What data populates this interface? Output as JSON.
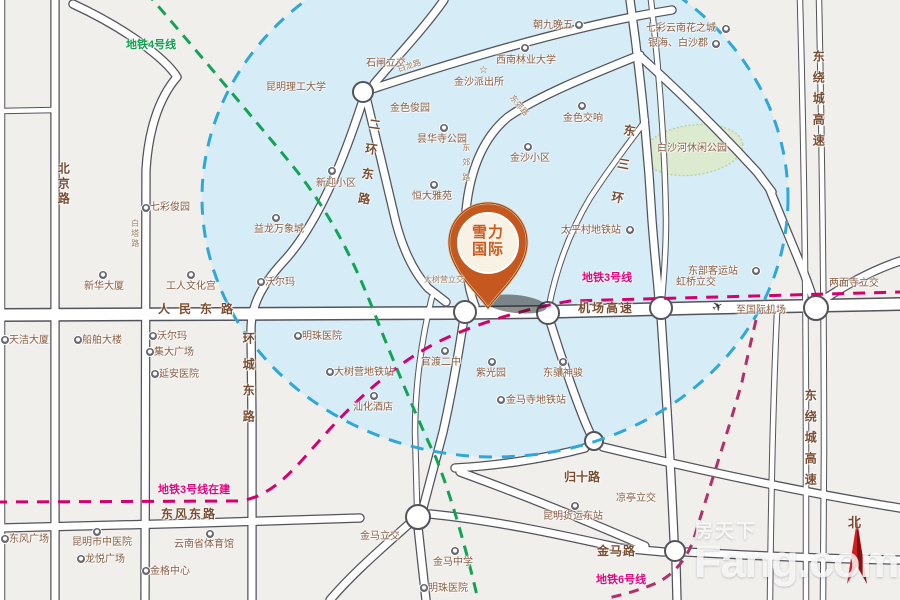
{
  "pin": {
    "line1": "雪力",
    "line2": "国际"
  },
  "watermark": {
    "cn": "房天下",
    "en": "Fang.com"
  },
  "compass": {
    "label": "北"
  },
  "glyphs": {
    "star": "☆",
    "plane": "✈"
  },
  "colors": {
    "background": "#f0efec",
    "coverage_zone_fill": "#d6ecf7",
    "coverage_zone_border": "#2ea7da",
    "metro_line4_green": "#12a355",
    "metro_line3_magenta": "#d4006e",
    "metro_line6_magenta": "#b13069",
    "road_fill": "#ffffff",
    "road_casing": "#53535b",
    "label_brown": "#8a5c40",
    "pin_orange": "#c4581f",
    "park_green": "#dcead0",
    "compass_red": "#cf1f1f"
  },
  "metro_labels": [
    {
      "n": "metro-line4-label",
      "t": "地铁4号线",
      "x": 126,
      "y": 39,
      "c": "green"
    },
    {
      "n": "metro-line3-label",
      "t": "地铁3号线",
      "x": 582,
      "y": 272,
      "c": "pink"
    },
    {
      "n": "metro-line3-construction-label",
      "t": "地铁3号线在建",
      "x": 158,
      "y": 484,
      "c": "pink"
    },
    {
      "n": "metro-line6-label",
      "t": "地铁6号线",
      "x": 596,
      "y": 574,
      "c": "pink"
    }
  ],
  "road_labels": [
    {
      "n": "road-label-renmin-donglu",
      "t": "人民东路",
      "x": 158,
      "y": 303,
      "ls": 9
    },
    {
      "n": "road-label-jichang-gaosu",
      "t": "机场高速",
      "x": 578,
      "y": 302,
      "ls": 2
    },
    {
      "n": "road-label-dongfeng-donglu",
      "t": "东风东路",
      "x": 161,
      "y": 508,
      "ls": 2
    },
    {
      "n": "road-label-jinma-lu",
      "t": "金马路",
      "x": 597,
      "y": 545,
      "ls": 1
    },
    {
      "n": "road-label-guishi-lu",
      "t": "归十路",
      "x": 564,
      "y": 471,
      "ls": 0
    },
    {
      "n": "road-label-beijing-lu",
      "t": "北京路",
      "x": 56,
      "y": 162,
      "v": 1,
      "ls": 3
    },
    {
      "n": "road-label-erhuan-donglu",
      "t": "二环东路",
      "x": 368,
      "y": 117,
      "v": 1,
      "ls": 13,
      "r": 8
    },
    {
      "n": "road-label-huancheng-donglu",
      "t": "环城东路",
      "x": 241,
      "y": 332,
      "v": 1,
      "ls": 14
    },
    {
      "n": "road-label-dongsanhuan",
      "t": "东三环",
      "x": 623,
      "y": 123,
      "v": 1,
      "ls": 22,
      "r": 10
    },
    {
      "n": "road-label-raocheng-north",
      "t": "东绕城高速",
      "x": 811,
      "y": 50,
      "v": 1,
      "ls": 9
    },
    {
      "n": "road-label-raocheng-south",
      "t": "东绕城高速",
      "x": 803,
      "y": 389,
      "v": 1,
      "ls": 9
    }
  ],
  "micro_labels": [
    {
      "n": "road-label-dongjiao-lu-vert",
      "t": "东郊路",
      "x": 461,
      "y": 143,
      "v": 1,
      "ls": 7
    },
    {
      "n": "road-label-dongjiao-lu-curve",
      "t": "东郊路",
      "x": 514,
      "y": 94,
      "r": 50
    },
    {
      "n": "road-label-bailong-lu",
      "t": "白龙路",
      "x": 397,
      "y": 66,
      "r": -17
    },
    {
      "n": "road-label-baita-lu",
      "t": "白塔路",
      "x": 130,
      "y": 219,
      "v": 1,
      "ls": 2
    }
  ],
  "poi_labels": [
    {
      "n": "poi-chaojiuwanwu",
      "t": "朝九晚五",
      "x": 533,
      "y": 20
    },
    {
      "n": "poi-qicai-yunnan-huazhicheng",
      "t": "七彩云南花之城",
      "x": 646,
      "y": 23
    },
    {
      "n": "poi-yinhai-baishajun",
      "t": "银海、白沙郡",
      "x": 648,
      "y": 38
    },
    {
      "n": "poi-kunming-ligong-daxue",
      "t": "昆明理工大学",
      "x": 266,
      "y": 82
    },
    {
      "n": "poi-shizha-lijiao",
      "t": "石闸立交",
      "x": 366,
      "y": 58
    },
    {
      "n": "poi-xinan-linye-daxue",
      "t": "西南林业大学",
      "x": 496,
      "y": 55
    },
    {
      "n": "poi-jinsha-paichusuo",
      "t": "金沙派出所",
      "x": 454,
      "y": 77
    },
    {
      "n": "poi-jinse-junyuan",
      "t": "金色俊园",
      "x": 390,
      "y": 103
    },
    {
      "n": "poi-jinse-jiaoxiang",
      "t": "金色交响",
      "x": 563,
      "y": 113
    },
    {
      "n": "poi-tanhuasi-gongyuan",
      "t": "昙华寺公园",
      "x": 417,
      "y": 134
    },
    {
      "n": "poi-jinsha-xiaoqu",
      "t": "金沙小区",
      "x": 510,
      "y": 153
    },
    {
      "n": "poi-xinying-xiaoqu",
      "t": "新迎小区",
      "x": 316,
      "y": 178
    },
    {
      "n": "poi-hengda-yayuan",
      "t": "恒大雅苑",
      "x": 412,
      "y": 191
    },
    {
      "n": "poi-baishahe-park",
      "t": "白沙河休闲公园",
      "x": 657,
      "y": 143
    },
    {
      "n": "poi-qicai-junyuan",
      "t": "七彩俊园",
      "x": 150,
      "y": 202
    },
    {
      "n": "poi-yilong-wanxiangcheng",
      "t": "益龙万象城",
      "x": 254,
      "y": 224
    },
    {
      "n": "poi-walmart-north",
      "t": "沃尔玛",
      "x": 265,
      "y": 277
    },
    {
      "n": "poi-xinhua-dasha",
      "t": "新华大厦",
      "x": 84,
      "y": 281
    },
    {
      "n": "poi-gongren-wenhuagong",
      "t": "工人文化宫",
      "x": 166,
      "y": 281
    },
    {
      "n": "poi-taipingcun-ditiezhan",
      "t": "太平村地铁站",
      "x": 561,
      "y": 225
    },
    {
      "n": "poi-dashuying-lijiao",
      "t": "大树营立交",
      "x": 424,
      "y": 276,
      "cls": "micro"
    },
    {
      "n": "poi-dongbu-keyunzhan",
      "t": "东部客运站",
      "x": 688,
      "y": 266
    },
    {
      "n": "poi-hongqiao-lijiao",
      "t": "虹桥立交",
      "x": 676,
      "y": 277
    },
    {
      "n": "poi-liangmiansi-lijiao",
      "t": "两面寺立交",
      "x": 829,
      "y": 278
    },
    {
      "n": "poi-zhi-guoji-jichang",
      "t": "至国际机场",
      "x": 736,
      "y": 305
    },
    {
      "n": "poi-tianjie-dasha",
      "t": "天洁大厦",
      "x": 9,
      "y": 335
    },
    {
      "n": "poi-chuanbo-dalou",
      "t": "船舶大楼",
      "x": 82,
      "y": 335
    },
    {
      "n": "poi-walmart-south",
      "t": "沃尔玛",
      "x": 157,
      "y": 331
    },
    {
      "n": "poi-jida-guangchang",
      "t": "集大广场",
      "x": 154,
      "y": 347
    },
    {
      "n": "poi-yanan-yiyuan",
      "t": "延安医院",
      "x": 159,
      "y": 369
    },
    {
      "n": "poi-mingzhu-yiyuan-north",
      "t": "明珠医院",
      "x": 302,
      "y": 331
    },
    {
      "n": "poi-dashuying-ditiezhan",
      "t": "大树营地铁站",
      "x": 334,
      "y": 367
    },
    {
      "n": "poi-guandu-erzhong",
      "t": "官渡二中",
      "x": 421,
      "y": 357
    },
    {
      "n": "poi-ziguangyuan",
      "t": "紫光园",
      "x": 476,
      "y": 368
    },
    {
      "n": "poi-dongxiang-shenjun",
      "t": "东骧神骏",
      "x": 543,
      "y": 368
    },
    {
      "n": "poi-jinmasi-ditiezhan",
      "t": "金马寺地铁站",
      "x": 506,
      "y": 395
    },
    {
      "n": "poi-shanhua-jiudian",
      "t": "汕化酒店",
      "x": 353,
      "y": 402
    },
    {
      "n": "poi-liangting-lijiao",
      "t": "凉亭立交",
      "x": 616,
      "y": 493
    },
    {
      "n": "poi-kunming-huoyun-dongzhan",
      "t": "昆明货运东站",
      "x": 543,
      "y": 511
    },
    {
      "n": "poi-dongfeng-guangchang",
      "t": "东风广场",
      "x": 9,
      "y": 534
    },
    {
      "n": "poi-kunmingshi-zhongyiyuan",
      "t": "昆明市中医院",
      "x": 72,
      "y": 537
    },
    {
      "n": "poi-longyue-guangchang",
      "t": "龙悦广场",
      "x": 85,
      "y": 554
    },
    {
      "n": "poi-yunnansheng-tiyuguan",
      "t": "云南省体育馆",
      "x": 174,
      "y": 539
    },
    {
      "n": "poi-jinge-zhongxin",
      "t": "金格中心",
      "x": 150,
      "y": 566
    },
    {
      "n": "poi-jinma-lijiao",
      "t": "金马立交",
      "x": 360,
      "y": 531
    },
    {
      "n": "poi-jinma-zhongxue",
      "t": "金马中学",
      "x": 433,
      "y": 557
    },
    {
      "n": "poi-mingzhu-yiyuan-south",
      "t": "明珠医院",
      "x": 428,
      "y": 583
    }
  ],
  "icons": [
    {
      "t": "star",
      "x": 479,
      "y": 66
    },
    {
      "t": "plane",
      "x": 712,
      "y": 300
    },
    {
      "t": "poi",
      "x": 575,
      "y": 21
    },
    {
      "t": "poi",
      "x": 722,
      "y": 25
    },
    {
      "t": "poi",
      "x": 712,
      "y": 40
    },
    {
      "t": "poi",
      "x": 521,
      "y": 44
    },
    {
      "t": "poi",
      "x": 578,
      "y": 102
    },
    {
      "t": "poi",
      "x": 440,
      "y": 124
    },
    {
      "t": "poi",
      "x": 524,
      "y": 143
    },
    {
      "t": "poi",
      "x": 328,
      "y": 167
    },
    {
      "t": "poi",
      "x": 430,
      "y": 181
    },
    {
      "t": "poi",
      "x": 142,
      "y": 204
    },
    {
      "t": "poi",
      "x": 272,
      "y": 214
    },
    {
      "t": "poi",
      "x": 257,
      "y": 278
    },
    {
      "t": "poi",
      "x": 99,
      "y": 271
    },
    {
      "t": "poi",
      "x": 187,
      "y": 271
    },
    {
      "t": "poi",
      "x": 626,
      "y": 226
    },
    {
      "t": "poi",
      "x": 752,
      "y": 267
    },
    {
      "t": "poi",
      "x": 1,
      "y": 336
    },
    {
      "t": "poi",
      "x": 74,
      "y": 336
    },
    {
      "t": "poi",
      "x": 149,
      "y": 332
    },
    {
      "t": "poi",
      "x": 146,
      "y": 348
    },
    {
      "t": "poi",
      "x": 151,
      "y": 370
    },
    {
      "t": "poi",
      "x": 294,
      "y": 332
    },
    {
      "t": "poi",
      "x": 326,
      "y": 368
    },
    {
      "t": "poi",
      "x": 441,
      "y": 347
    },
    {
      "t": "poi",
      "x": 488,
      "y": 358
    },
    {
      "t": "poi",
      "x": 559,
      "y": 358
    },
    {
      "t": "poi",
      "x": 497,
      "y": 396
    },
    {
      "t": "poi",
      "x": 370,
      "y": 392
    },
    {
      "t": "poi",
      "x": 571,
      "y": 502
    },
    {
      "t": "poi",
      "x": 1,
      "y": 535
    },
    {
      "t": "poi",
      "x": 93,
      "y": 528
    },
    {
      "t": "poi",
      "x": 77,
      "y": 555
    },
    {
      "t": "poi",
      "x": 206,
      "y": 530
    },
    {
      "t": "poi",
      "x": 142,
      "y": 567
    },
    {
      "t": "poi",
      "x": 451,
      "y": 547
    },
    {
      "t": "poi",
      "x": 420,
      "y": 584
    }
  ]
}
